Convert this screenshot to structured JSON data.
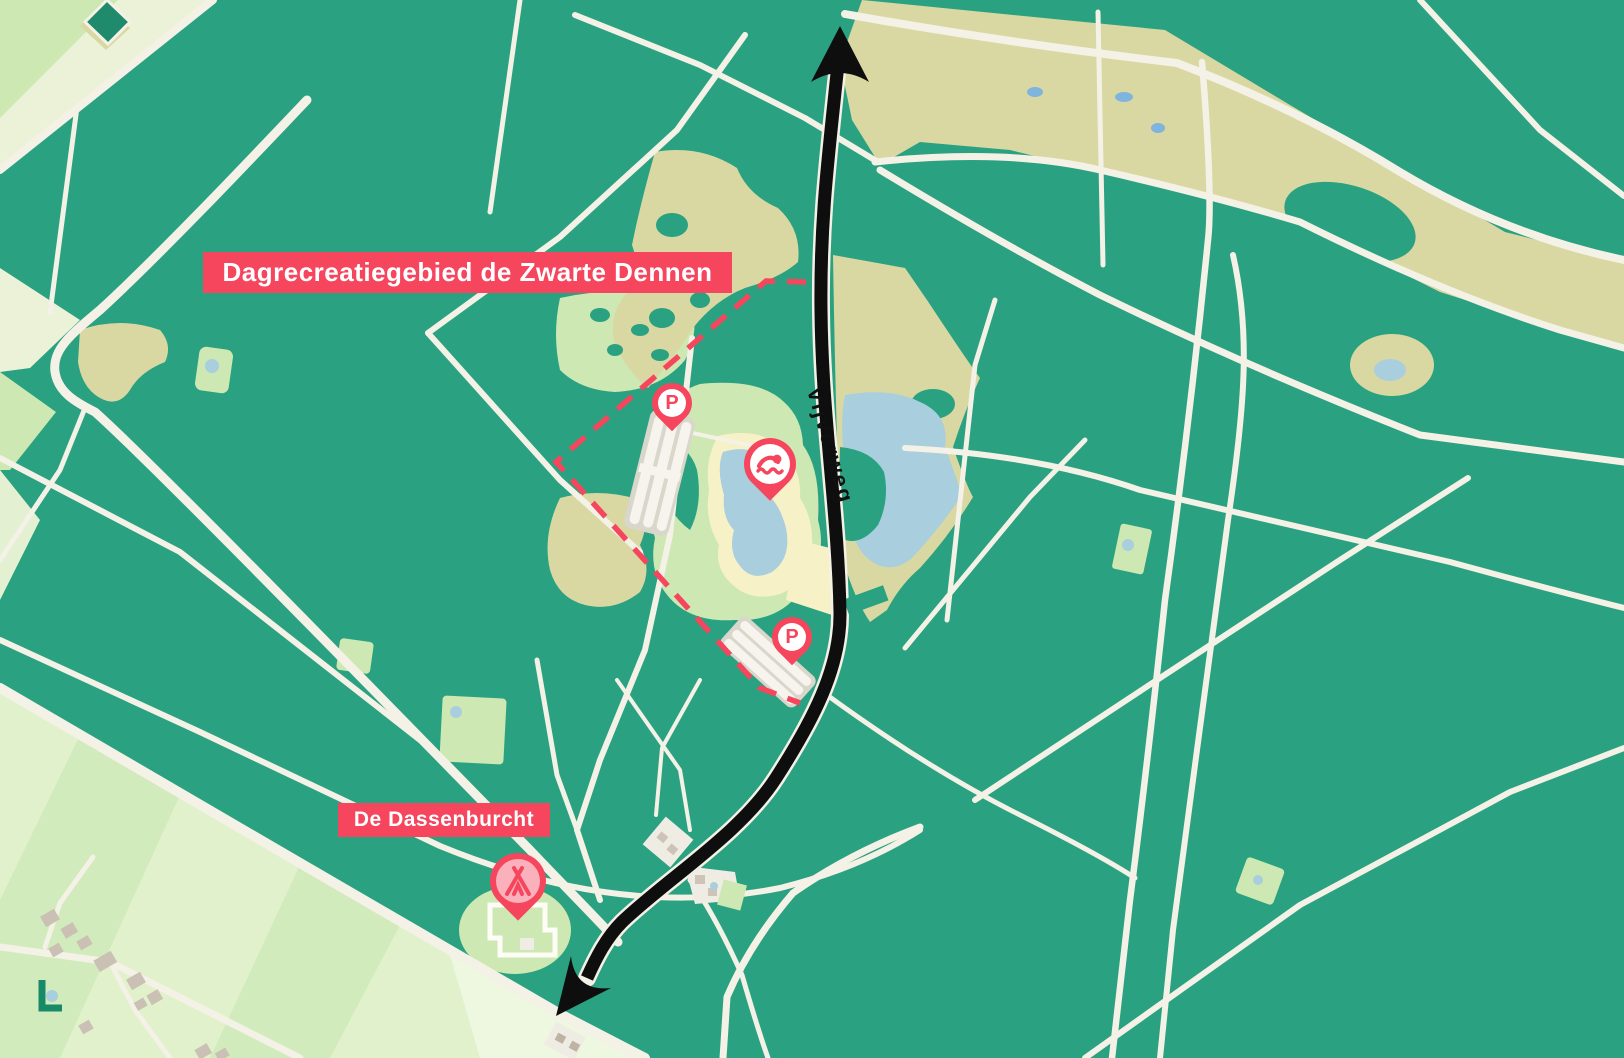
{
  "labels": {
    "region": "Dagrecreatiegebied de Zwarte Dennen",
    "site": "De Dassenburcht",
    "road": "Vijverweg"
  },
  "markers": {
    "parking_north": {
      "label": "P",
      "meaning": "parking"
    },
    "parking_south": {
      "label": "P",
      "meaning": "parking"
    },
    "swimming": {
      "meaning": "swimming-lake"
    },
    "camping": {
      "meaning": "campsite"
    }
  },
  "route": {
    "description": "black two-headed arrow along Vijverweg"
  },
  "colors": {
    "accent_red": "#f5465e",
    "forest_green": "#2aa181",
    "field_light_green": "#cde8b2",
    "field_pale_green": "#ecf2d8",
    "sand_tan": "#d9d8a2",
    "water_blue": "#a9cedd",
    "beach_cream": "#f7f1c7",
    "road_cream": "#f4f1e6",
    "route_black": "#0e0e0e"
  }
}
